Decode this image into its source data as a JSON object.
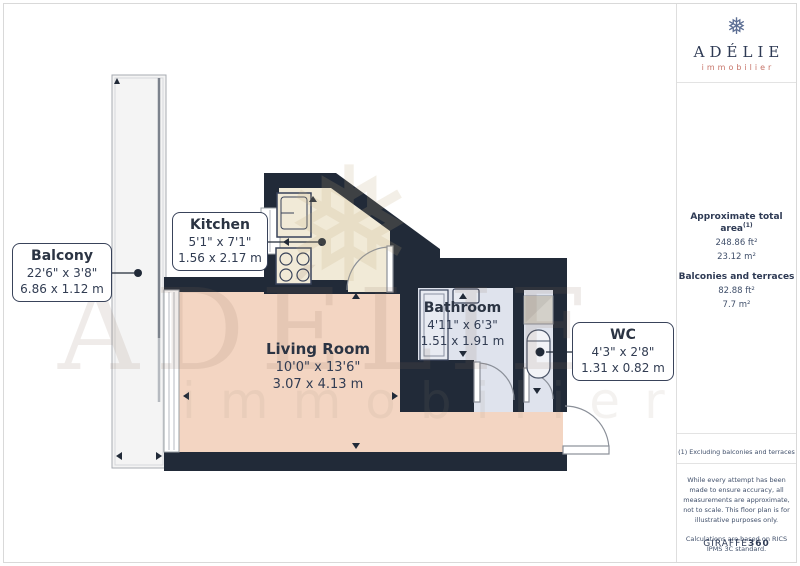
{
  "logo": {
    "title": "ADÉLIE",
    "subtitle": "immobilier",
    "icon": "❅"
  },
  "watermark": {
    "line1": "ADÉLIE",
    "line2": "immobilier",
    "snowflake": "❅"
  },
  "rooms": {
    "balcony": {
      "name": "Balcony",
      "imperial": "22'6\" x 3'8\"",
      "metric": "6.86 x 1.12 m"
    },
    "kitchen": {
      "name": "Kitchen",
      "imperial": "5'1\" x 7'1\"",
      "metric": "1.56 x 2.17 m"
    },
    "living": {
      "name": "Living Room",
      "imperial": "10'0\" x 13'6\"",
      "metric": "3.07 x 4.13 m"
    },
    "bathroom": {
      "name": "Bathroom",
      "imperial": "4'11\" x 6'3\"",
      "metric": "1.51 x 1.91 m"
    },
    "wc": {
      "name": "WC",
      "imperial": "4'3\" x 2'8\"",
      "metric": "1.31 x 0.82 m"
    }
  },
  "sidebar": {
    "total_area_label": "Approximate total area",
    "footnote_ref": "(1)",
    "total_area_ft": "248.86 ft²",
    "total_area_m": "23.12 m²",
    "balconies_label": "Balconies and terraces",
    "balconies_ft": "82.88 ft²",
    "balconies_m": "7.7 m²",
    "footnote": "(1) Excluding balconies and terraces",
    "disclaimer_1": "While every attempt has been made to ensure accuracy, all measurements are approximate, not to scale. This floor plan is for illustrative purposes only.",
    "disclaimer_2": "Calculations are based on RICS IPMS 3C standard.",
    "brand_normal": "GIRAFFE",
    "brand_bold": "360"
  },
  "colors": {
    "wall": "#212a38",
    "living_floor": "#f3d5c2",
    "kitchen_floor": "#f1ead7",
    "bath_floor": "#dfe3ed",
    "balcony_floor": "#f4f4f4",
    "accent": "#c7756a",
    "navy_text": "#2e3a54"
  }
}
